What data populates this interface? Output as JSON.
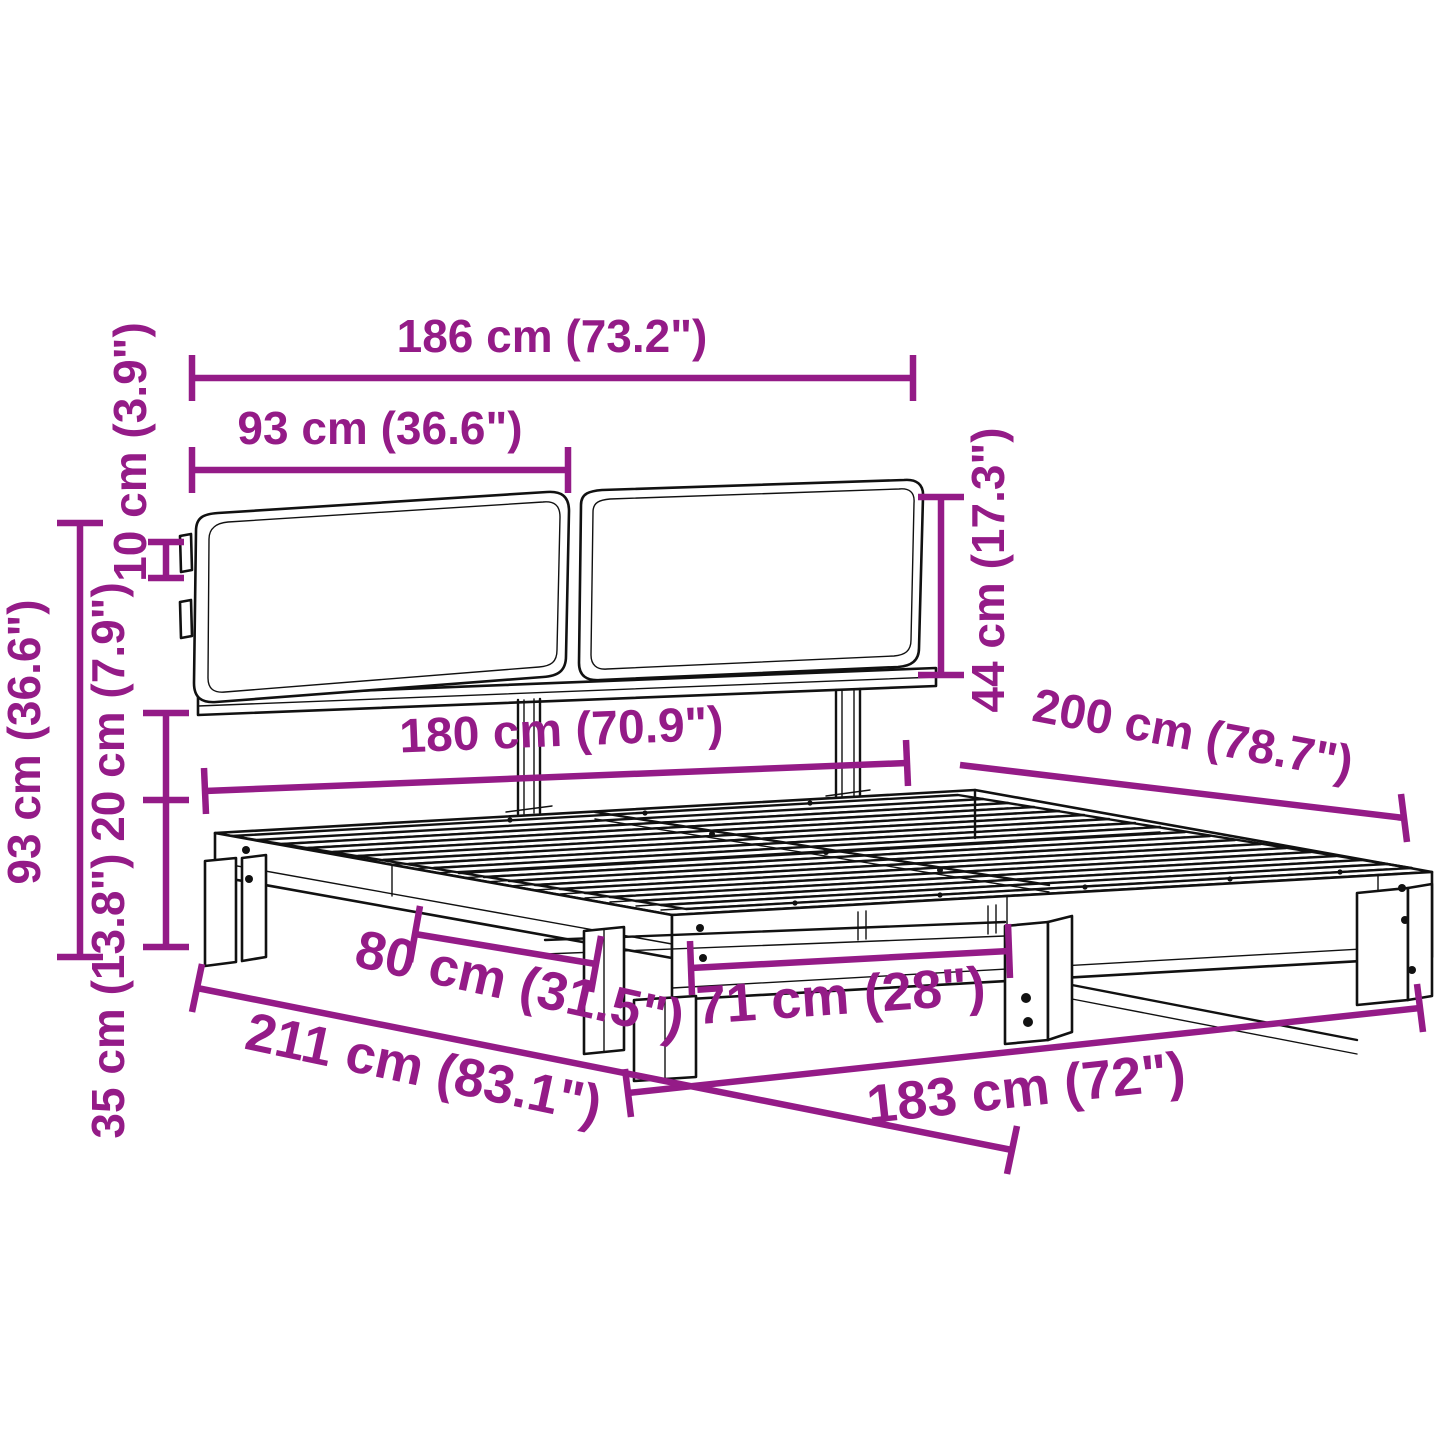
{
  "diagram": {
    "type": "product-dimension-diagram",
    "subject": "bed frame with headboard cushions",
    "colors": {
      "dimension_annotation": "#941B87",
      "line_art": "#111111",
      "background": "#FFFFFF"
    },
    "dimensions": [
      {
        "id": "headboard-total-width",
        "label": "186 cm (73.2\")",
        "cm": 186,
        "inches": "73.2\""
      },
      {
        "id": "cushion-width",
        "label": "93 cm (36.6\")",
        "cm": 93,
        "inches": "36.6\""
      },
      {
        "id": "cushion-height",
        "label": "44 cm (17.3\")",
        "cm": 44,
        "inches": "17.3\""
      },
      {
        "id": "cushion-rail-overlap",
        "label": "10 cm (3.9\")",
        "cm": 10,
        "inches": "3.9\""
      },
      {
        "id": "frame-height",
        "label": "20 cm (7.9\")",
        "cm": 20,
        "inches": "7.9\""
      },
      {
        "id": "underbed-clearance",
        "label": "35 cm (13.8\")",
        "cm": 35,
        "inches": "13.8\""
      },
      {
        "id": "total-height",
        "label": "93 cm (36.6\")",
        "cm": 93,
        "inches": "36.6\""
      },
      {
        "id": "inner-width",
        "label": "180 cm (70.9\")",
        "cm": 180,
        "inches": "70.9\""
      },
      {
        "id": "bed-length",
        "label": "200 cm (78.7\")",
        "cm": 200,
        "inches": "78.7\""
      },
      {
        "id": "outer-width",
        "label": "183 cm (72\")",
        "cm": 183,
        "inches": "72\""
      },
      {
        "id": "total-length",
        "label": "211 cm (83.1\")",
        "cm": 211,
        "inches": "83.1\""
      },
      {
        "id": "side-leg-spacing",
        "label": "80 cm (31.5\")",
        "cm": 80,
        "inches": "31.5\""
      },
      {
        "id": "front-leg-spacing",
        "label": "71 cm (28\")",
        "cm": 71,
        "inches": "28\""
      }
    ]
  }
}
